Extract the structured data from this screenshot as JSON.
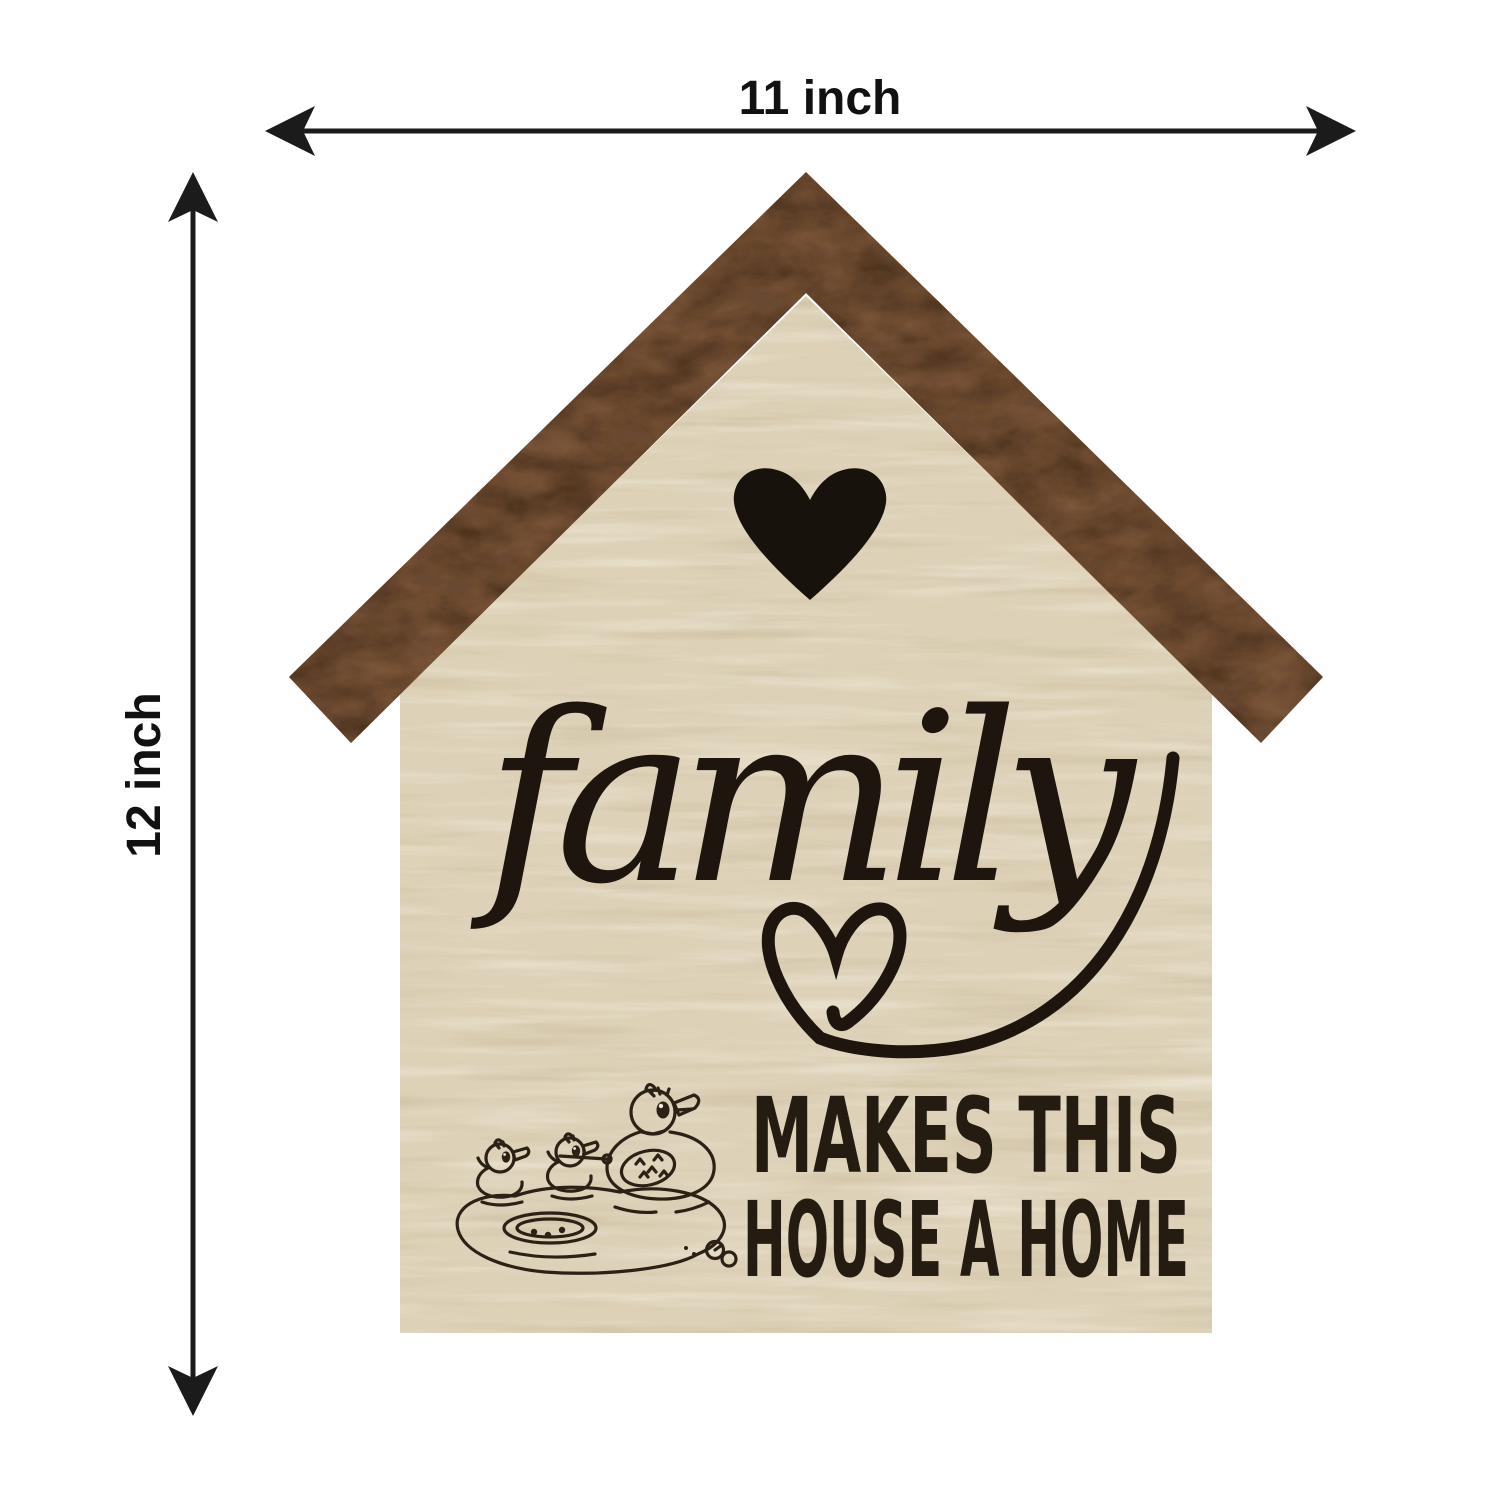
{
  "annotations": {
    "width_label": "11 inch",
    "height_label": "12 inch"
  },
  "sign": {
    "script_word": "family",
    "caption_line1": "MAKES THIS",
    "caption_line2": "HOUSE A HOME",
    "motifs": {
      "top_heart": "solid-heart-icon",
      "underline": "heart-swash-flourish-icon",
      "illustration": "mother-duck-with-two-ducklings-in-pond"
    },
    "colors": {
      "roof_wood": "#6a4830",
      "roof_wood_dark": "#3c2614",
      "roof_wood_light": "#8a6242",
      "panel_wood": "#ddd1b7",
      "panel_wood_light": "#f4eee0",
      "panel_wood_dark": "#c5b493",
      "ink": "#20170e"
    }
  },
  "dimension_style": {
    "arrow_color": "#1b1b1b"
  }
}
